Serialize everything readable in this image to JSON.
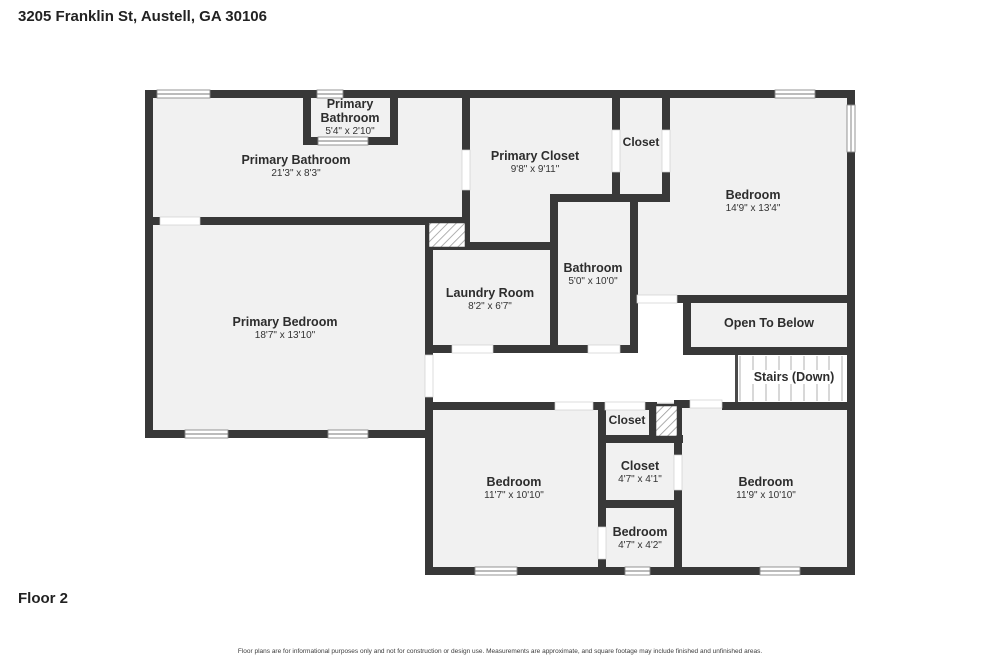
{
  "header": {
    "address": "3205 Franklin St, Austell, GA 30106"
  },
  "floor": {
    "label": "Floor 2"
  },
  "footer": {
    "disclaimer": "Floor plans are for informational purposes only and not for construction or design use. Measurements are approximate, and square footage may include finished and unfinished areas."
  },
  "rooms": {
    "primary_bathroom_small": {
      "name": "Primary Bathroom",
      "dims": "5'4\" x 2'10\""
    },
    "primary_bathroom": {
      "name": "Primary Bathroom",
      "dims": "21'3\" x 8'3\""
    },
    "primary_closet": {
      "name": "Primary Closet",
      "dims": "9'8\" x 9'11\""
    },
    "closet_top": {
      "name": "Closet"
    },
    "bedroom_top_right": {
      "name": "Bedroom",
      "dims": "14'9\" x 13'4\""
    },
    "bathroom": {
      "name": "Bathroom",
      "dims": "5'0\" x 10'0\""
    },
    "laundry_room": {
      "name": "Laundry Room",
      "dims": "8'2\" x 6'7\""
    },
    "primary_bedroom": {
      "name": "Primary Bedroom",
      "dims": "18'7\" x 13'10\""
    },
    "open_to_below": {
      "name": "Open To Below"
    },
    "stairs": {
      "name": "Stairs (Down)"
    },
    "closet_small": {
      "name": "Closet"
    },
    "closet_47": {
      "name": "Closet",
      "dims": "4'7\" x 4'1\""
    },
    "bedroom_bottom_middle": {
      "name": "Bedroom",
      "dims": "11'7\" x 10'10\""
    },
    "bedroom_small": {
      "name": "Bedroom",
      "dims": "4'7\" x 4'2\""
    },
    "bedroom_bottom_right": {
      "name": "Bedroom",
      "dims": "11'9\" x 10'10\""
    }
  },
  "colors": {
    "wall": "#383838",
    "room_fill": "#f1f1f1",
    "background": "#ffffff",
    "hatch": "#9a9a9a"
  }
}
